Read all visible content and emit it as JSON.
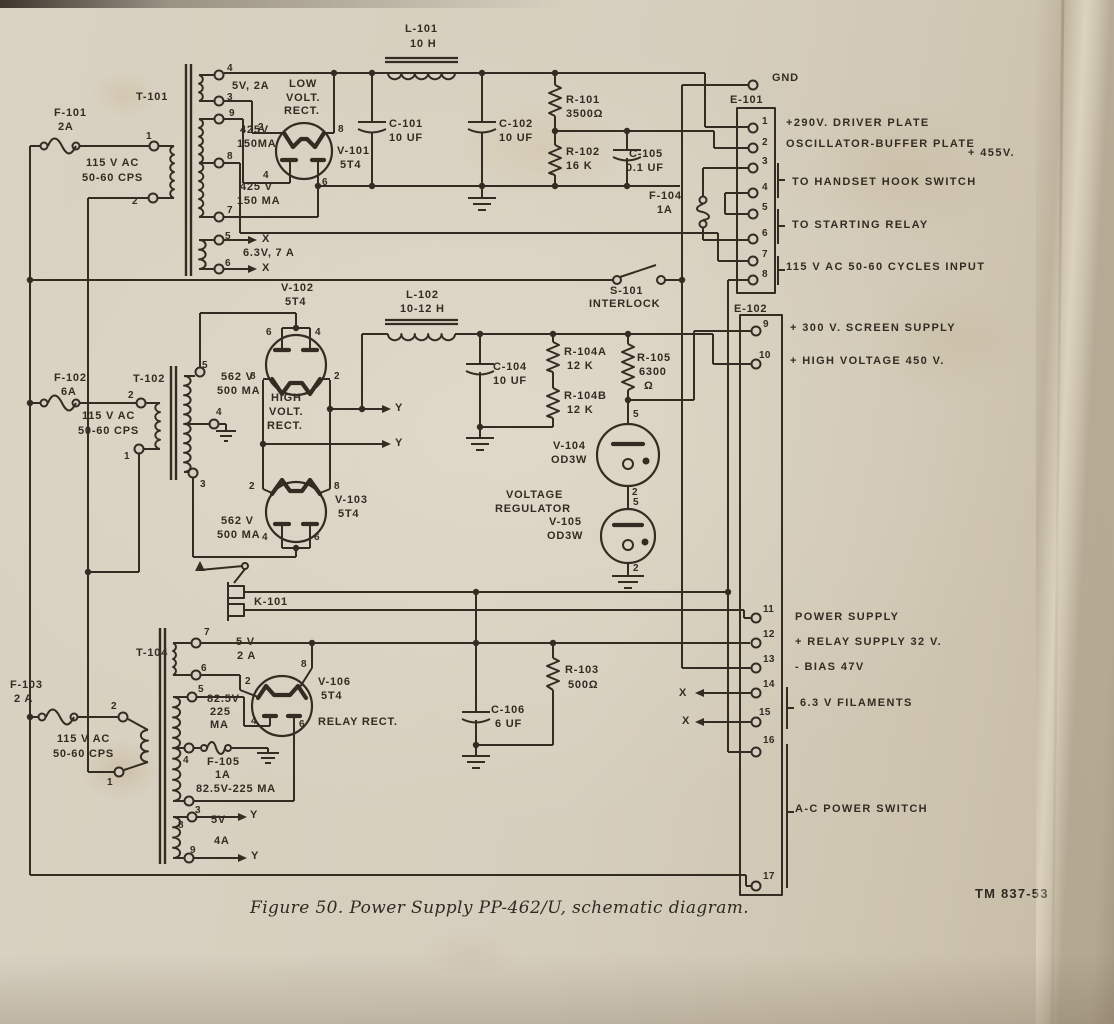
{
  "figure": {
    "caption": "Figure 50.  Power Supply PP-462/U, schematic diagram.",
    "tm": "TM 837-53"
  },
  "colors": {
    "ink": "#332c22",
    "paper": "#d6cec0"
  },
  "shared": {
    "ac_line1": "115 V AC",
    "ac_line2": "50-60 CPS",
    "x_marker": "X",
    "y_marker": "Y",
    "gnd": "GND"
  },
  "digits": [
    "0",
    "1",
    "2",
    "3",
    "4",
    "5",
    "6",
    "7",
    "8",
    "9"
  ],
  "e102_nums": {
    "n10": "10",
    "n11": "11",
    "n12": "12",
    "n13": "13",
    "n14": "14",
    "n15": "15",
    "n16": "16",
    "n17": "17"
  },
  "terminal_strips": {
    "e101": {
      "id": "E-101",
      "outputs": {
        "p1": "+290V. DRIVER PLATE",
        "p2": "OSCILLATOR-BUFFER PLATE",
        "p2b": "+ 455V.",
        "p34": "TO HANDSET HOOK SWITCH",
        "p56": "TO STARTING RELAY",
        "p78": "115 V AC 50-60 CYCLES INPUT"
      }
    },
    "e102": {
      "id": "E-102",
      "outputs": {
        "p9": "+ 300 V. SCREEN SUPPLY",
        "p10": "+ HIGH VOLTAGE 450 V.",
        "p11": "POWER SUPPLY",
        "p12": "+ RELAY SUPPLY 32 V.",
        "p13": "- BIAS 47V",
        "p14_15": "6.3 V FILAMENTS",
        "p16_17": "A-C POWER SWITCH"
      }
    }
  },
  "transformers": {
    "t101": {
      "id": "T-101",
      "w_5v": "5V, 2A",
      "w_425_1": "425V",
      "w_425_1_ma": "150MA",
      "w_425_2": "425 V",
      "w_425_2_ma": "150 MA",
      "w_63v": "6.3V, 7 A"
    },
    "t102": {
      "id": "T-102",
      "w_top": "562 V",
      "w_top_ma": "500 MA",
      "w_bot": "562 V",
      "w_bot_ma": "500 MA"
    },
    "t104": {
      "id": "T-104",
      "w_5v": "5 V",
      "w_5v_a": "2 A",
      "w_825": "82.5V",
      "w_825_ma": "225",
      "w_825_ma2": "MA",
      "w_825_tap": "82.5V-225 MA",
      "w_5v4": "5V",
      "w_5v4_a": "4A"
    }
  },
  "tubes": {
    "v101": {
      "id": "V-101",
      "type": "5T4",
      "role1": "LOW",
      "role2": "VOLT.",
      "role3": "RECT."
    },
    "v102": {
      "id": "V-102",
      "type": "5T4",
      "role1": "HIGH",
      "role2": "VOLT.",
      "role3": "RECT."
    },
    "v103": {
      "id": "V-103",
      "type": "5T4"
    },
    "v104": {
      "id": "V-104",
      "type": "OD3W"
    },
    "v105": {
      "id": "V-105",
      "type": "OD3W"
    },
    "vr_role1": "VOLTAGE",
    "vr_role2": "REGULATOR",
    "v106": {
      "id": "V-106",
      "type": "5T4",
      "role": "RELAY RECT."
    }
  },
  "components": {
    "l101": {
      "id": "L-101",
      "value": "10 H"
    },
    "l102": {
      "id": "L-102",
      "value": "10-12 H"
    },
    "c101": {
      "id": "C-101",
      "value": "10 UF"
    },
    "c102": {
      "id": "C-102",
      "value": "10 UF"
    },
    "c104": {
      "id": "C-104",
      "value": "10 UF"
    },
    "c105": {
      "id": "C-105",
      "value": "0.1 UF"
    },
    "c106": {
      "id": "C-106",
      "value": "6 UF"
    },
    "r101": {
      "id": "R-101",
      "value": "3500Ω"
    },
    "r102": {
      "id": "R-102",
      "value": "16 K"
    },
    "r103": {
      "id": "R-103",
      "value": "500Ω"
    },
    "r104a": {
      "id": "R-104A",
      "value": "12 K"
    },
    "r104b": {
      "id": "R-104B",
      "value": "12 K"
    },
    "r105": {
      "id": "R-105",
      "value": "6300",
      "unit": "Ω"
    },
    "k101": {
      "id": "K-101"
    },
    "s101": {
      "id": "S-101",
      "caption": "INTERLOCK"
    }
  },
  "fuses": {
    "f101": {
      "id": "F-101",
      "rating": "2A"
    },
    "f102": {
      "id": "F-102",
      "rating": "6A"
    },
    "f103": {
      "id": "F-103",
      "rating": "2 A"
    },
    "f104": {
      "id": "F-104",
      "rating": "1A"
    },
    "f105": {
      "id": "F-105",
      "rating": "1A"
    }
  }
}
